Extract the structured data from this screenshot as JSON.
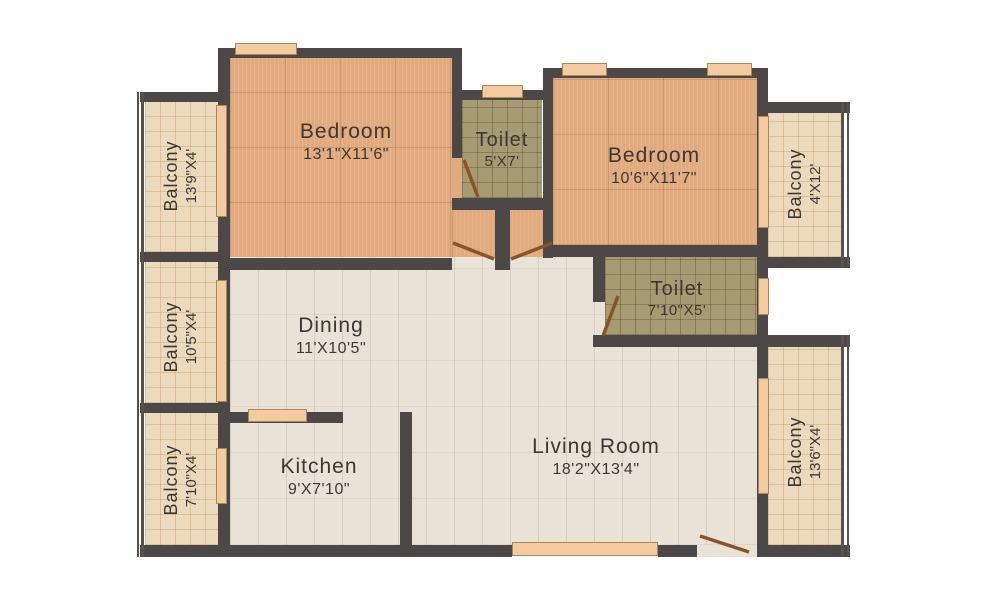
{
  "rooms": {
    "bedroom1": {
      "name": "Bedroom",
      "dims": "13'1\"X11'6\""
    },
    "toilet1": {
      "name": "Toilet",
      "dims": "5'X7'"
    },
    "bedroom2": {
      "name": "Bedroom",
      "dims": "10'6\"X11'7\""
    },
    "toilet2": {
      "name": "Toilet",
      "dims": "7'10\"X5'"
    },
    "dining": {
      "name": "Dining",
      "dims": "11'X10'5\""
    },
    "kitchen": {
      "name": "Kitchen",
      "dims": "9'X7'10\""
    },
    "living": {
      "name": "Living Room",
      "dims": "18'2\"X13'4\""
    },
    "balcony_left_top": {
      "name": "Balcony",
      "dims": "13'9\"X4'"
    },
    "balcony_left_mid": {
      "name": "Balcony",
      "dims": "10'5\"X4'"
    },
    "balcony_left_bottom": {
      "name": "Balcony",
      "dims": "7'10\"X4'"
    },
    "balcony_right_top": {
      "name": "Balcony",
      "dims": "4'X12'"
    },
    "balcony_right_bottom": {
      "name": "Balcony",
      "dims": "13'6\"X4'"
    }
  },
  "colors": {
    "wall": "#4b4847",
    "bedroom_floor": "#e2ab7f",
    "toilet_floor": "#a79b73",
    "hall_floor": "#e9e3d7",
    "balcony_floor": "#ecdabc",
    "window": "#f4cba1",
    "door": "#8a5428",
    "text": "#3b3734"
  }
}
